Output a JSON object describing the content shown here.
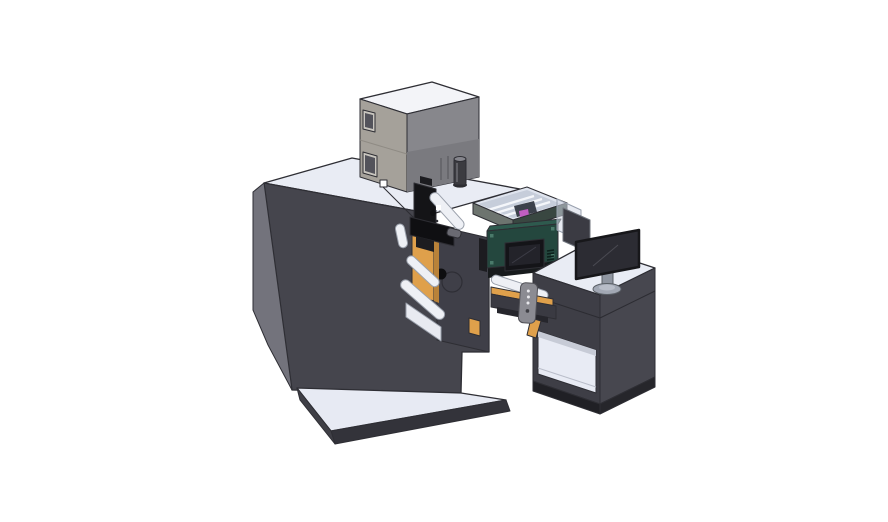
{
  "scene": {
    "background": "#ffffff",
    "description_parts": {
      "main_cabinet": "main machine cabinet",
      "equipment_box": "top equipment box",
      "filter_cylinder": "cylindrical canister",
      "media_tray": "clear media tray",
      "print_mechanism": "web print mechanism",
      "rollers": "guide rollers",
      "controller_unit": "green controller with display",
      "transfer_beam": "transfer beam",
      "hand_controller": "hanging hand controller",
      "base_platform": "machine base platform",
      "desk": "operator desk",
      "desk_shelf": "open desk shelf",
      "divider_panel": "desk side panels",
      "monitor": "desktop monitor"
    }
  },
  "colors": {
    "background": "#ffffff",
    "edge": "#2e2e34",
    "machineTop": "#e9ecf4",
    "machineFront": "#45454d",
    "machineLeft": "#73737c",
    "platformTop": "#e7eaf3",
    "platformFront": "#33333a",
    "platformSide": "#3f3f46",
    "boxTop": "#f3f4f8",
    "boxLeft": "#a5a19a",
    "boxFront": "#87878c",
    "boxFrontShade": "#7a7a7f",
    "boxSeam": "#8f8b84",
    "boxWindowFrame": "#c9c6bf",
    "boxWindowGlass": "#53535b",
    "boxSlot": "#5f5f64",
    "whiteSquare": "#ffffff",
    "cylinderBody": "#3b3b40",
    "cylinderTop": "#85858c",
    "cylinderBase": "#2c2c31",
    "cylinderHighlight": "#6a6a70",
    "trayRim": "#dfe4ee",
    "trayInner": "#c6cdda",
    "trayRail": "#f4f6fa",
    "trayFaceLeft": "#6d746f",
    "trayFaceRight": "#394741",
    "trayPart": "#3c414b",
    "magenta": "#c05ec0",
    "mechPlate": "#3f3f48",
    "mechHole": "#0e0e10",
    "mechHoleRing": "#2e2e35",
    "orange": "#dfa04b",
    "orangeShade": "#b98239",
    "roller": "#eef0f5",
    "rollerStroke": "#9aa0ab",
    "bracketLight": "#e8eaf1",
    "black": "#141417",
    "blackDeep": "#0f0f12",
    "grayCylinder": "#6a6a72",
    "darkBit": "#1c1c20",
    "greenFace": "#24473e",
    "greenTop": "#2e5a4e",
    "greenScrew": "#4a7a6a",
    "greenUnder": "#181b1d",
    "greenVent": "#0d201b",
    "screenBezel": "#141418",
    "screenInner": "#23232a",
    "screenGlare": "#3c3c46",
    "beamDark": "#3a3a42",
    "beamShadow": "#26262c",
    "remote": "#8b8b92",
    "remoteDot": "#e8e8ec",
    "remoteDotDark": "#3e3e44",
    "deskTop": "#e9ecf4",
    "deskLeft": "#3e3e46",
    "deskRight": "#47474f",
    "deskSeam": "#2c2c32",
    "deskKickLeft": "#202025",
    "deskKickRight": "#26262b",
    "shelfInner": "#e8ebf4",
    "shelfShadow": "#c7cbd6",
    "shelfLine": "#b9bdc9",
    "dividerGlass": "#d3d9e6",
    "dividerGlassStroke": "#98a0ae",
    "dividerDark": "#3b3b43",
    "dividerStroke": "#70757e",
    "monitorScreen": "#2c2c33",
    "monitorStroke": "#17171a",
    "monitorGlare": "#4a4a52",
    "standNeck": "#8f95a0",
    "standBase": "#a2a8b4",
    "standBaseInner": "#b8bdc8",
    "standStroke": "#5a5f66"
  }
}
